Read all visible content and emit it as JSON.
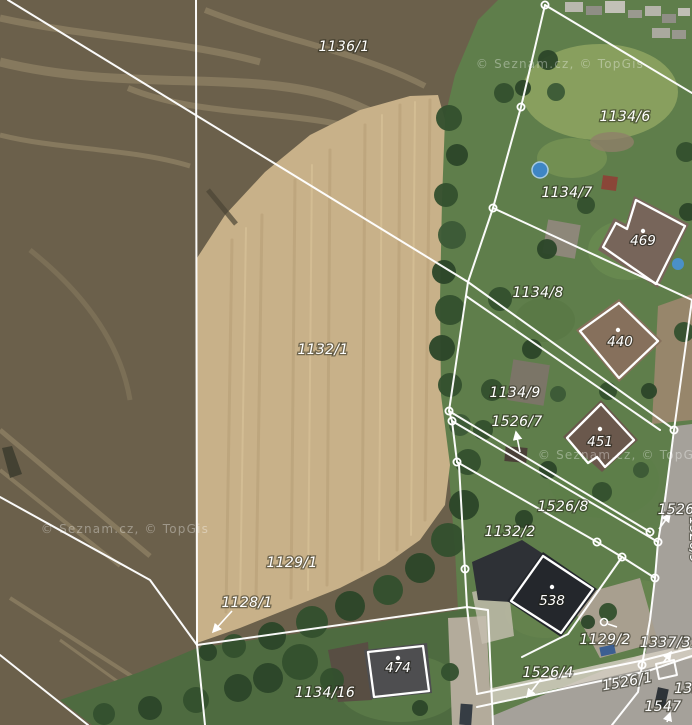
{
  "map": {
    "width": 692,
    "height": 725,
    "type": "cadastral-parcels-over-aerial-imagery",
    "watermark": {
      "text": "© Seznam.cz, © TopGis",
      "positions": [
        {
          "x": 560,
          "y": 68
        },
        {
          "x": 125,
          "y": 533
        },
        {
          "x": 622,
          "y": 459
        }
      ]
    },
    "palette": {
      "boundary_line": "#ffffff",
      "label_text": "#ffffff",
      "field_dark": "#6b604b",
      "field_light": "#c8b189",
      "grass": "#5f7e4b",
      "tree": "#33502e",
      "road": "#a5a19a",
      "path": "#d4cec1",
      "pool": "#3f86c4",
      "roof_dark": "#24272c",
      "roof_brown": "#77655a"
    },
    "parcel_labels": [
      {
        "text": "1136/1",
        "x": 344,
        "y": 51
      },
      {
        "text": "1134/6",
        "x": 625,
        "y": 121
      },
      {
        "text": "1134/7",
        "x": 567,
        "y": 197
      },
      {
        "text": "1134/8",
        "x": 538,
        "y": 297
      },
      {
        "text": "1134/9",
        "x": 515,
        "y": 397
      },
      {
        "text": "1526/7",
        "x": 517,
        "y": 426
      },
      {
        "text": "1526/8",
        "x": 563,
        "y": 511
      },
      {
        "text": "1526",
        "x": 676,
        "y": 514
      },
      {
        "text": "1132/2",
        "x": 510,
        "y": 536
      },
      {
        "text": "1132/1",
        "x": 323,
        "y": 354
      },
      {
        "text": "1129/1",
        "x": 292,
        "y": 567
      },
      {
        "text": "1129/2",
        "x": 605,
        "y": 644
      },
      {
        "text": "1337/31",
        "x": 670,
        "y": 647
      },
      {
        "text": "1128/1",
        "x": 247,
        "y": 607
      },
      {
        "text": "1526/4",
        "x": 548,
        "y": 677
      },
      {
        "text": "1526/1",
        "x": 628,
        "y": 686,
        "rotate": -10
      },
      {
        "text": "1134/16",
        "x": 325,
        "y": 697
      },
      {
        "text": "1547",
        "x": 663,
        "y": 711
      },
      {
        "text": "133",
        "x": 688,
        "y": 693
      }
    ],
    "building_labels": [
      {
        "text": "469",
        "x": 643,
        "y": 245
      },
      {
        "text": "440",
        "x": 620,
        "y": 346
      },
      {
        "text": "451",
        "x": 600,
        "y": 446
      },
      {
        "text": "538",
        "x": 552,
        "y": 605
      },
      {
        "text": "474",
        "x": 398,
        "y": 672
      }
    ],
    "road_label": {
      "text": "1526/9",
      "x": 690,
      "y": 540,
      "rotate": 90
    },
    "boundary_lines": [
      {
        "points": [
          [
            8,
            0
          ],
          [
            468,
            282
          ]
        ]
      },
      {
        "points": [
          [
            196,
            0
          ],
          [
            197,
            645
          ]
        ]
      },
      {
        "points": [
          [
            197,
            645
          ],
          [
            205,
            725
          ]
        ]
      },
      {
        "points": [
          [
            0,
            497
          ],
          [
            150,
            580
          ],
          [
            197,
            645
          ]
        ]
      },
      {
        "points": [
          [
            0,
            655
          ],
          [
            88,
            725
          ]
        ]
      },
      {
        "points": [
          [
            197,
            645
          ],
          [
            467,
            607
          ],
          [
            459,
            465
          ],
          [
            457,
            462
          ]
        ]
      },
      {
        "points": [
          [
            545,
            5
          ],
          [
            521,
            107
          ],
          [
            493,
            208
          ],
          [
            468,
            282
          ],
          [
            449,
            411
          ],
          [
            452,
            421
          ],
          [
            457,
            462
          ]
        ]
      },
      {
        "points": [
          [
            545,
            5
          ],
          [
            692,
            93
          ]
        ]
      },
      {
        "points": [
          [
            493,
            208
          ],
          [
            692,
            300
          ]
        ]
      },
      {
        "points": [
          [
            468,
            282
          ],
          [
            672,
            428
          ]
        ]
      },
      {
        "points": [
          [
            466,
            296
          ],
          [
            660,
            430
          ]
        ]
      },
      {
        "points": [
          [
            449,
            411
          ],
          [
            650,
            532
          ]
        ]
      },
      {
        "points": [
          [
            452,
            421
          ],
          [
            658,
            542
          ]
        ]
      },
      {
        "points": [
          [
            457,
            462
          ],
          [
            597,
            542
          ],
          [
            622,
            557
          ],
          [
            655,
            578
          ]
        ]
      },
      {
        "points": [
          [
            692,
            300
          ],
          [
            674,
            430
          ],
          [
            665,
            500
          ],
          [
            658,
            542
          ]
        ]
      },
      {
        "points": [
          [
            658,
            542
          ],
          [
            655,
            578
          ],
          [
            650,
            620
          ],
          [
            642,
            665
          ],
          [
            638,
            692
          ],
          [
            612,
            725
          ]
        ]
      },
      {
        "points": [
          [
            622,
            557
          ],
          [
            568,
            634
          ],
          [
            522,
            657
          ]
        ]
      },
      {
        "points": [
          [
            467,
            607
          ],
          [
            488,
            610
          ],
          [
            493,
            725
          ]
        ]
      },
      {
        "points": [
          [
            467,
            607
          ],
          [
            477,
            694
          ]
        ]
      },
      {
        "points": [
          [
            477,
            694
          ],
          [
            640,
            661
          ],
          [
            692,
            648
          ]
        ]
      },
      {
        "points": [
          [
            477,
            707
          ],
          [
            648,
            671
          ],
          [
            692,
            656
          ]
        ]
      },
      {
        "points": [
          [
            656,
            664
          ],
          [
            674,
            660
          ],
          [
            677,
            675
          ],
          [
            659,
            679
          ],
          [
            656,
            664
          ]
        ]
      }
    ],
    "vertex_markers": [
      [
        545,
        5
      ],
      [
        521,
        107
      ],
      [
        493,
        208
      ],
      [
        449,
        411
      ],
      [
        452,
        421
      ],
      [
        457,
        462
      ],
      [
        674,
        430
      ],
      [
        650,
        532
      ],
      [
        658,
        542
      ],
      [
        597,
        542
      ],
      [
        622,
        557
      ],
      [
        655,
        578
      ],
      [
        642,
        665
      ],
      [
        465,
        569
      ]
    ],
    "building_outlines": [
      {
        "id": "469",
        "points": [
          [
            603,
            247
          ],
          [
            616,
            223
          ],
          [
            627,
            229
          ],
          [
            636,
            200
          ],
          [
            685,
            226
          ],
          [
            656,
            284
          ]
        ],
        "dot": [
          643,
          231
        ]
      },
      {
        "id": "440",
        "points": [
          [
            580,
            331
          ],
          [
            619,
            303
          ],
          [
            658,
            341
          ],
          [
            619,
            378
          ]
        ],
        "dot": [
          618,
          330
        ]
      },
      {
        "id": "451",
        "points": [
          [
            567,
            438
          ],
          [
            601,
            404
          ],
          [
            634,
            440
          ],
          [
            605,
            467
          ],
          [
            597,
            457
          ],
          [
            588,
            463
          ]
        ],
        "dot": [
          600,
          429
        ]
      },
      {
        "id": "538",
        "points": [
          [
            511,
            601
          ],
          [
            543,
            556
          ],
          [
            593,
            589
          ],
          [
            561,
            633
          ]
        ],
        "dot": [
          552,
          587
        ]
      },
      {
        "id": "474",
        "points": [
          [
            368,
            652
          ],
          [
            423,
            646
          ],
          [
            429,
            691
          ],
          [
            374,
            697
          ]
        ],
        "dot": [
          398,
          658
        ]
      }
    ],
    "label_arrows": [
      {
        "from": [
          520,
          452
        ],
        "to": [
          516,
          432
        ]
      },
      {
        "from": [
          659,
          529
        ],
        "to": [
          670,
          514
        ]
      },
      {
        "from": [
          663,
          663
        ],
        "to": [
          671,
          652
        ]
      },
      {
        "from": [
          667,
          722
        ],
        "to": [
          670,
          713
        ]
      },
      {
        "from": [
          232,
          611
        ],
        "to": [
          213,
          632
        ]
      },
      {
        "from": [
          541,
          679
        ],
        "to": [
          527,
          697
        ]
      }
    ],
    "well_symbol": {
      "cx": 604,
      "cy": 622,
      "r": 3.5,
      "tail": [
        [
          608,
          624
        ],
        [
          617,
          627
        ]
      ]
    }
  }
}
